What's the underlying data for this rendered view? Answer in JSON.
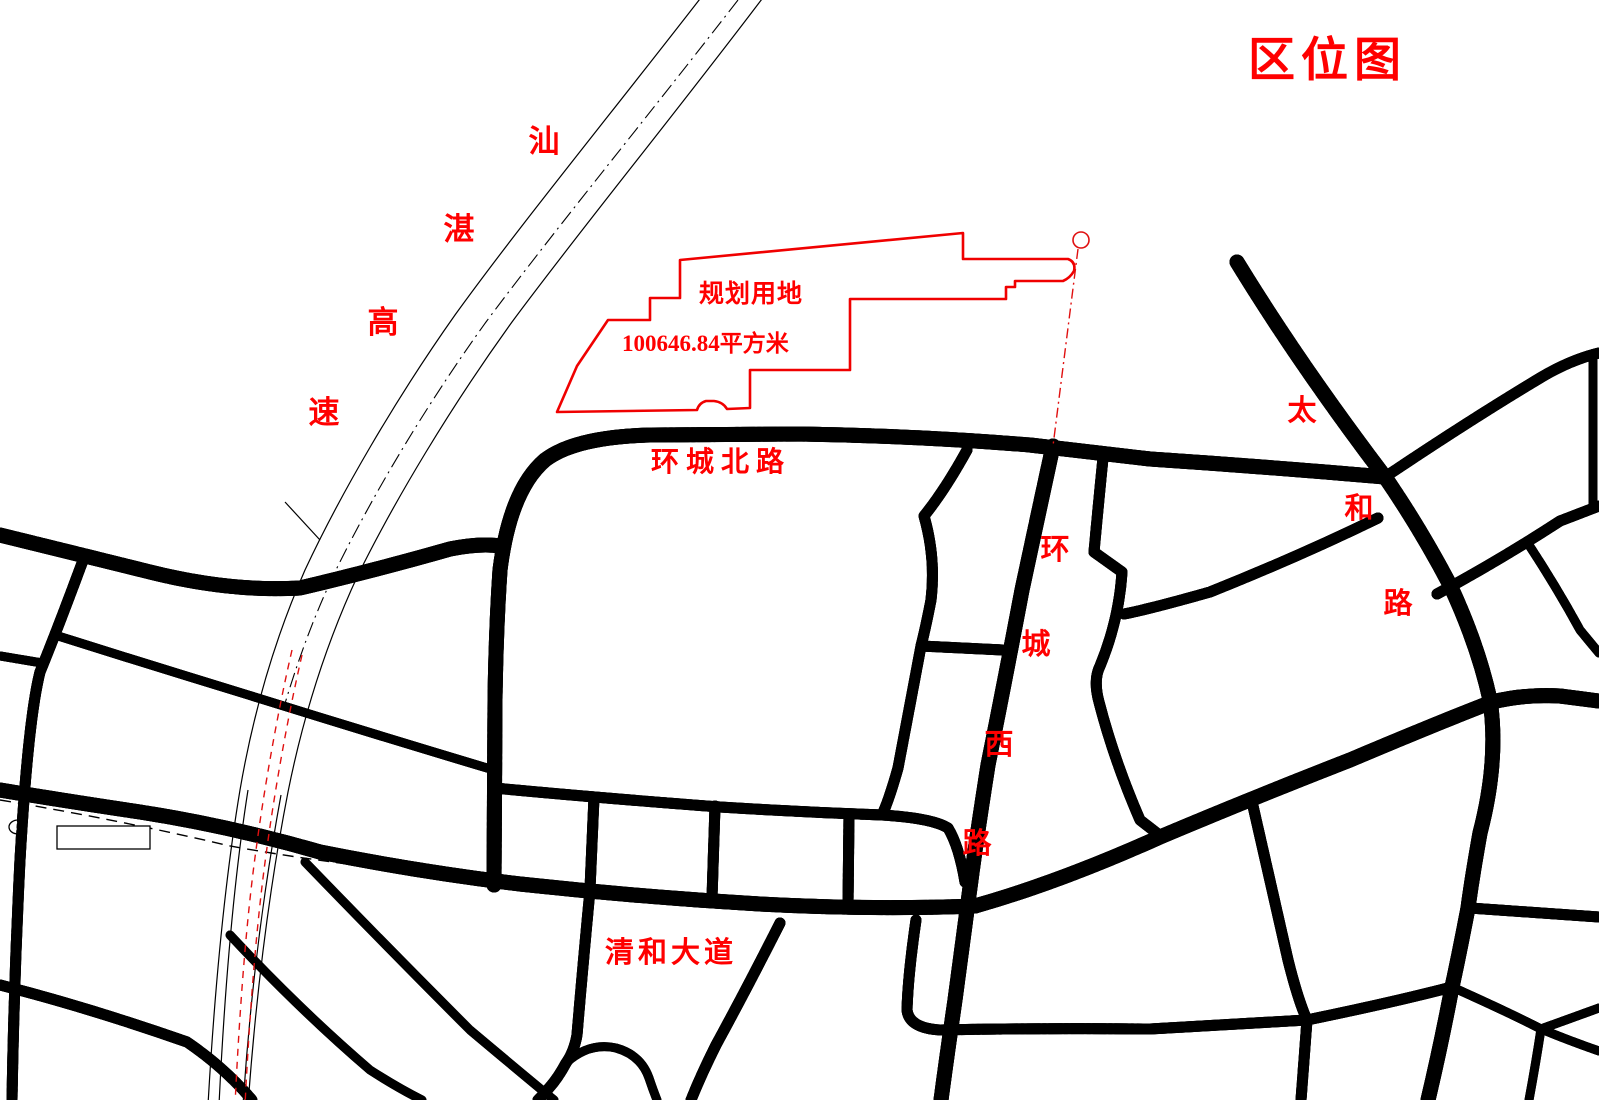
{
  "title": {
    "text": "区位图"
  },
  "parcel": {
    "label": "规划用地",
    "area": "100646.84平方米"
  },
  "roads": {
    "expressway": {
      "name": "汕湛高速",
      "chars": [
        "汕",
        "湛",
        "高",
        "速"
      ]
    },
    "north_ring": {
      "name": "环城北路"
    },
    "west_ring": {
      "name": "环城西路",
      "chars": [
        "环",
        "城",
        "西",
        "路"
      ]
    },
    "qinghe": {
      "name": "清和大道"
    },
    "taihe": {
      "name": "太和路",
      "chars": [
        "太",
        "和",
        "路"
      ]
    }
  },
  "symbols": {
    "boundary_marker": "circle-marker",
    "bridge": "bridge-rectangle-symbol"
  },
  "colors": {
    "line_black": "#000000",
    "label_red": "#ff0000",
    "centerline_red": "#dd0f0f",
    "parcel_red": "#f00000",
    "background": "#ffffff"
  }
}
